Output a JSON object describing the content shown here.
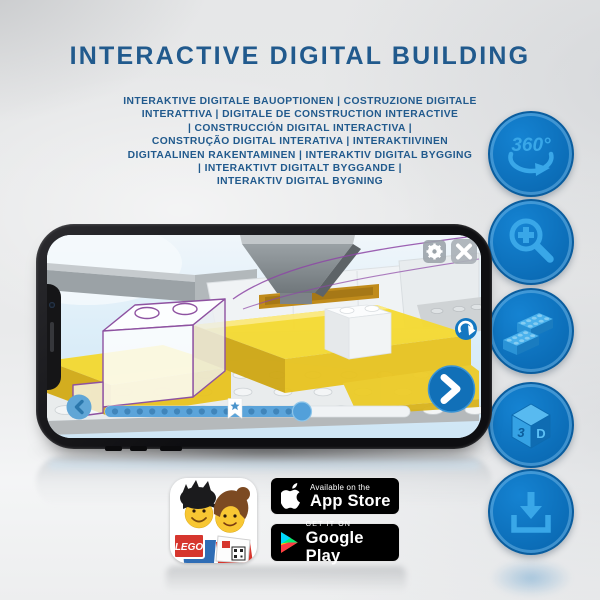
{
  "title": "INTERACTIVE DIGITAL BUILDING",
  "subtitle_lines": [
    "INTERAKTIVE DIGITALE BAUOPTIONEN | COSTRUZIONE DIGITALE",
    "INTERATTIVA | DIGITALE DE CONSTRUCTION INTERACTIVE",
    "| CONSTRUCCIÓN DIGITAL INTERACTIVA |",
    "CONSTRUÇÃO DIGITAL INTERATIVA | INTERAKTIIVINEN",
    "DIGITAALINEN RAKENTAMINEN | INTERAKTIV DIGITAL BYGGING",
    "| INTERAKTIVT DIGITALT BYGGANDE |",
    "INTERAKTIV DIGITAL BYGNING"
  ],
  "feature_icons": {
    "items": [
      "360-degree-rotation",
      "zoom-in",
      "lego-bricks",
      "3d-view",
      "download"
    ],
    "rotation_label": "360°",
    "cube_left": "3",
    "cube_right": "D"
  },
  "app_icon": {
    "lego_logo": "LEGO"
  },
  "badges": {
    "app_store": {
      "top": "Available on the",
      "bottom": "App Store"
    },
    "google_play": {
      "top": "GET IT ON",
      "bottom": "Google Play"
    }
  },
  "colors": {
    "title_blue": "#215a8d",
    "icon_circle_blue": "#0d72bd",
    "icon_glyph_blue": "#39a7e8",
    "app_ui_blue": "#1170b8",
    "lego_yellow": "#f4d92f",
    "ghost_outline_purple": "#8e52a1",
    "badge_black": "#000000"
  }
}
